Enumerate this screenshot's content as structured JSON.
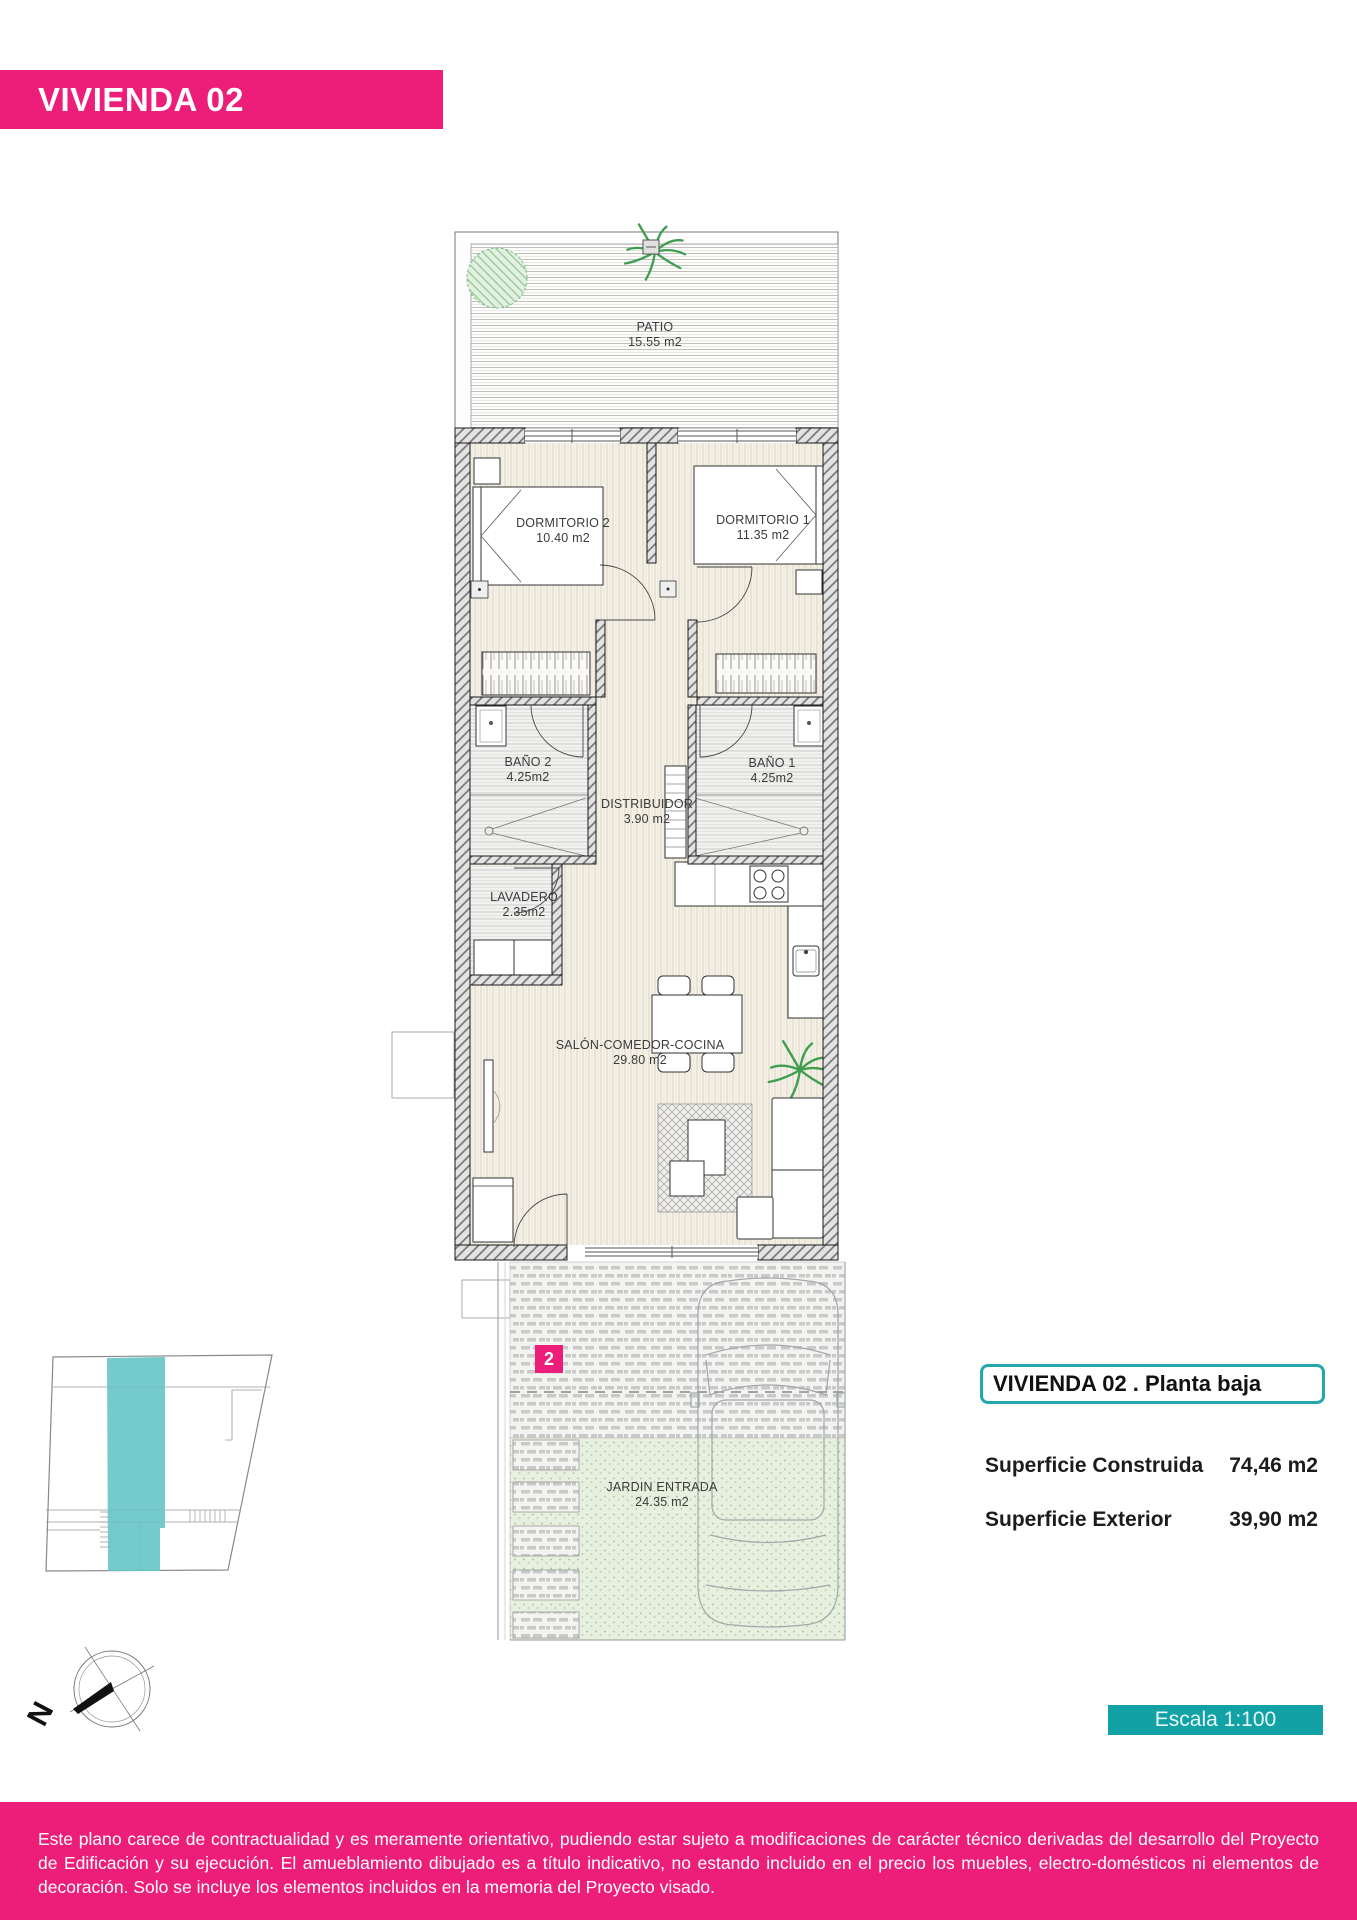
{
  "page": {
    "title_bar": "VIVIENDA 02"
  },
  "plan": {
    "rooms": [
      {
        "id": "patio",
        "name": "PATIO",
        "area": "15.55 m2"
      },
      {
        "id": "dormitorio2",
        "name": "DORMITORIO 2",
        "area": "10.40 m2"
      },
      {
        "id": "dormitorio1",
        "name": "DORMITORIO 1",
        "area": "11.35 m2"
      },
      {
        "id": "bano2",
        "name": "BAÑO 2",
        "area": "4.25m2"
      },
      {
        "id": "bano1",
        "name": "BAÑO 1",
        "area": "4.25m2"
      },
      {
        "id": "distribuidor",
        "name": "DISTRIBUIDOR",
        "area": "3.90 m2"
      },
      {
        "id": "lavadero",
        "name": "LAVADERO",
        "area": "2.35m2"
      },
      {
        "id": "salon",
        "name": "SALÓN-COMEDOR-COCINA",
        "area": "29.80 m2"
      },
      {
        "id": "jardin",
        "name": "JARDIN ENTRADA",
        "area": "24.35 m2"
      }
    ],
    "unit_badge": "2",
    "compass_label": "N"
  },
  "info_panel": {
    "title": "VIVIENDA 02 .  Planta baja",
    "rows": [
      {
        "label": "Superficie Construida",
        "value": "74,46 m2"
      },
      {
        "label": "Superficie Exterior",
        "value": "39,90 m2"
      }
    ],
    "scale_label": "Escala 1:100"
  },
  "footer": {
    "disclaimer": "Este plano carece de contractualidad y es meramente orientativo, pudiendo estar sujeto a modificaciones de carácter técnico derivadas del desarrollo del Proyecto de Edificación y su ejecución. El amueblamiento dibujado es a título indicativo, no estando incluido en el precio los muebles, electro-domésticos ni elementos de decoración. Solo se incluye los elementos incluidos en la memoria del Proyecto visado."
  },
  "colors": {
    "brand_pink": "#EC1E79",
    "teal": "#12A2A6",
    "teal_light": "#66C4C7"
  }
}
